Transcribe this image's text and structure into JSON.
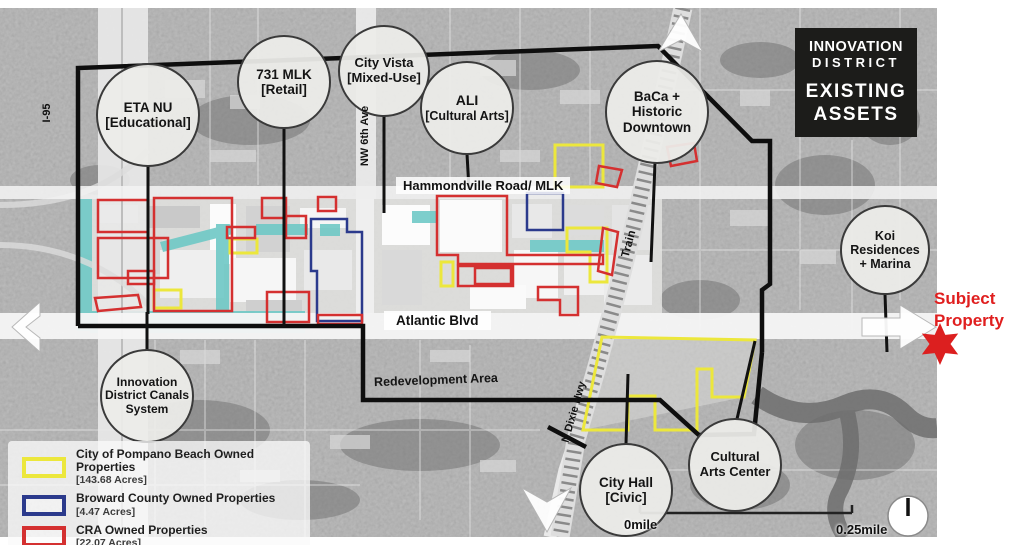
{
  "map_title": {
    "l1": "INNOVATION",
    "l2": "DISTRICT",
    "l3": "EXISTING",
    "l4": "ASSETS"
  },
  "assets": [
    {
      "lines": [
        "ETA NU",
        "[Educational]"
      ]
    },
    {
      "lines": [
        "731 MLK",
        "[Retail]"
      ]
    },
    {
      "lines": [
        "City Vista",
        "[Mixed-Use]"
      ]
    },
    {
      "lines": [
        "ALI",
        "[Cultural Arts]"
      ]
    },
    {
      "lines": [
        "BaCa +",
        "Historic",
        "Downtown"
      ]
    },
    {
      "lines": [
        "Koi",
        "Residences",
        "+ Marina"
      ]
    },
    {
      "lines": [
        "Innovation",
        "District Canals",
        "System"
      ]
    },
    {
      "lines": [
        "City Hall",
        "[Civic]"
      ]
    },
    {
      "lines": [
        "Cultural",
        "Arts Center"
      ]
    }
  ],
  "roads": {
    "i95": "I-95",
    "nw_6th": "NW 6th Ave",
    "hammondville": "Hammondville Road/ MLK",
    "atlantic": "Atlantic Blvd",
    "train": "Train",
    "dixie": "N Dixie Hwy",
    "redevelopment_area": "Redevelopment Area"
  },
  "legend": {
    "items": [
      {
        "label": "City of Pompano Beach Owned Properties",
        "acres": "[143.68 Acres]",
        "color": "#ece73c"
      },
      {
        "label": "Broward County Owned Properties",
        "acres": "[4.47 Acres]",
        "color": "#2b3a8c"
      },
      {
        "label": "CRA Owned Properties",
        "acres": "[22.07 Acres]",
        "color": "#d43030"
      }
    ]
  },
  "subject_property": {
    "l1": "Subject",
    "l2": "Property",
    "color": "#e01f1f"
  },
  "scale": {
    "start": "0mile",
    "end": "0.25mile"
  },
  "colors": {
    "boundary": "#0e0e0e",
    "canal": "#6fc9c6",
    "cra_red": "#d43030",
    "city_yellow": "#ece73c",
    "county_blue": "#2b3a8c",
    "title_bg": "#1c1c1a",
    "subject_red": "#e01f1f"
  }
}
